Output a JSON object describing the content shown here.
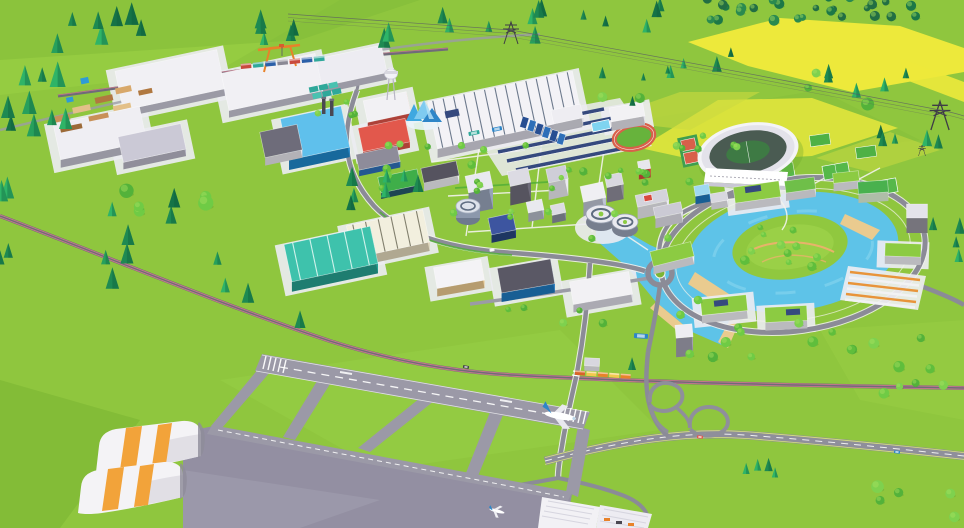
{
  "canvas": {
    "w": 964,
    "h": 528
  },
  "palette": {
    "grass": "#8FC63E",
    "grass_light": "#9AD047",
    "grass_dark": "#7CB534",
    "field_yellow": "#EDE93B",
    "field_pale": "#CBDB40",
    "water": "#5EC3E8",
    "water_light": "#8FD9F0",
    "sand": "#EACB8F",
    "road": "#8B8B97",
    "road_edge": "#F2F2EF",
    "highway": "#8F8F9B",
    "runway": "#9B99A7",
    "apron": "#938FA2",
    "rail": "#6F6B79",
    "rail_pink": "#C9798C",
    "pad": "#ECEBF1",
    "roof_green": "#8CCB42",
    "roof_white": "#F2F1F4",
    "stadium_bowl": "#4A5B52",
    "stadium_shell": "#F4F4F7",
    "pitch": "#3E7A44",
    "track_red": "#D8604A",
    "solar": "#35497E",
    "crane_orange": "#E8822A",
    "hangar_stripe": "#F2A33A",
    "pool": "#7FD4F0"
  },
  "scene": {
    "buildings": [
      [
        "warehouse-nw-a",
        170,
        80,
        104,
        40,
        -12,
        7,
        "#C7C5D3",
        "#F1F0F4",
        1,
        0,
        ""
      ],
      [
        "warehouse-nw-b",
        100,
        133,
        88,
        36,
        -12,
        8,
        "#C2C0CE",
        "#EFEEF3",
        1,
        0,
        ""
      ],
      [
        "warehouse-nw-c",
        152,
        143,
        64,
        26,
        -12,
        7,
        "#B8B6C5",
        "#CBC9D6",
        1,
        0,
        ""
      ],
      [
        "warehouse-n-d",
        272,
        82,
        96,
        38,
        -12,
        7,
        "#C7C5D3",
        "#F1F0F4",
        1,
        0,
        ""
      ],
      [
        "warehouse-n-e",
        346,
        67,
        78,
        28,
        -12,
        7,
        "#C7C5D3",
        "#EDECF2",
        1,
        0,
        ""
      ],
      [
        "factory-blue",
        315,
        133,
        62,
        42,
        -12,
        10,
        "#1F86C8",
        "#5FC0EC",
        1,
        0,
        ""
      ],
      [
        "factory-annex",
        281,
        141,
        38,
        26,
        -12,
        8,
        "#E5E4EB",
        "#6E6C7A",
        0,
        0,
        ""
      ],
      [
        "red-hall-a",
        387,
        107,
        44,
        22,
        -12,
        6,
        "#DE5348",
        "#F2F1F4",
        1,
        0,
        ""
      ],
      [
        "red-hall-b",
        384,
        135,
        48,
        24,
        -12,
        6,
        "#DE5348",
        "#E2584C",
        1,
        0,
        ""
      ],
      [
        "blue-low-office",
        378,
        158,
        42,
        16,
        -12,
        6,
        "#2E6FB8",
        "#8E8C9A",
        0,
        0,
        ""
      ],
      [
        "green-roof-lab",
        399,
        181,
        40,
        16,
        -12,
        6,
        "#27586A",
        "#3FAE49",
        0,
        0,
        ""
      ],
      [
        "production-hall",
        505,
        110,
        148,
        48,
        -12,
        9,
        "#D6D5E0",
        "#F3F2F6",
        1,
        14,
        "#55647A"
      ],
      [
        "office-n1",
        538,
        108,
        46,
        16,
        -12,
        9,
        "#E4E3EA",
        "#F2F1F4",
        1,
        0,
        ""
      ],
      [
        "office-n2",
        567,
        114,
        30,
        14,
        -12,
        8,
        "#DADAE3",
        "#EEEDF2",
        0,
        0,
        ""
      ],
      [
        "office-n3",
        627,
        112,
        34,
        14,
        -10,
        9,
        "#E4E3EA",
        "#F2F1F4",
        1,
        0,
        ""
      ],
      [
        "dark-roof-low",
        440,
        172,
        36,
        15,
        -12,
        8,
        "#EFEFF3",
        "#55535F",
        0,
        0,
        ""
      ],
      [
        "office-tower-a",
        479,
        182,
        25,
        17,
        -12,
        21,
        "#97A3B8",
        "#E9E9EF",
        0,
        0,
        ""
      ],
      [
        "office-tower-b",
        519,
        177,
        21,
        15,
        -12,
        19,
        "#6E6C7A",
        "#DCDBE3",
        0,
        0,
        ""
      ],
      [
        "office-tower-c",
        557,
        174,
        20,
        14,
        -12,
        17,
        "#EBEAF0",
        "#CFCED8",
        0,
        0,
        ""
      ],
      [
        "office-tower-d",
        593,
        192,
        23,
        16,
        -12,
        19,
        "#BFC4D4",
        "#EFEFF3",
        0,
        0,
        ""
      ],
      [
        "office-tower-e",
        614,
        180,
        17,
        12,
        -12,
        15,
        "#8E8C9A",
        "#D8D7DF",
        0,
        0,
        ""
      ],
      [
        "red-cube-office",
        644,
        165,
        12,
        9,
        -10,
        9,
        "#D84A3E",
        "#E8E7ED",
        0,
        0,
        ""
      ],
      [
        "navy-solar-office",
        502,
        224,
        25,
        17,
        -12,
        8,
        "#27457C",
        "#3D55A0",
        0,
        0,
        ""
      ],
      [
        "campus-cube-1",
        535,
        206,
        16,
        11,
        -12,
        9,
        "#B5BAC7",
        "#E9E9EF",
        0,
        0,
        ""
      ],
      [
        "campus-cube-2",
        558,
        209,
        14,
        10,
        -12,
        8,
        "#8A8F9F",
        "#DDDCE4",
        0,
        0,
        ""
      ],
      [
        "slab-east-1",
        652,
        198,
        32,
        12,
        -12,
        12,
        "#EBEAF0",
        "#D4D3DC",
        0,
        0,
        ""
      ],
      [
        "slab-east-2",
        668,
        210,
        28,
        11,
        -12,
        10,
        "#E0DFE8",
        "#CBCAD4",
        0,
        0,
        ""
      ],
      [
        "cream-warehouse",
        388,
        234,
        78,
        33,
        -12,
        9,
        "#E2D7BA",
        "#F2EFDE",
        1,
        6,
        "#6E6C5A"
      ],
      [
        "teal-warehouse",
        331,
        254,
        88,
        38,
        -12,
        10,
        "#27A090",
        "#3EC2AC",
        1,
        5,
        "#EAFBF6"
      ],
      [
        "white-warehouse-s",
        459,
        274,
        48,
        21,
        -10,
        8,
        "#E9C88E",
        "#F4F3F6",
        1,
        0,
        ""
      ],
      [
        "blue-warehouse",
        526,
        276,
        54,
        25,
        -10,
        9,
        "#1F78BE",
        "#5A5865",
        1,
        0,
        ""
      ],
      [
        "east-warehouse",
        601,
        288,
        60,
        23,
        -10,
        8,
        "#DBDAE4",
        "#F2F1F4",
        1,
        0,
        ""
      ],
      [
        "ring-bldg-w",
        672,
        254,
        42,
        15,
        -14,
        8,
        "#EFEEF3",
        "#8CCB42",
        0,
        0,
        ""
      ],
      [
        "ring-bldg-sw",
        724,
        305,
        46,
        16,
        -6,
        8,
        "#EFEEF3",
        "#8CCB42",
        1,
        0,
        ""
      ],
      [
        "ring-bldg-s",
        786,
        314,
        42,
        15,
        -3,
        8,
        "#EFEEF3",
        "#8CCB42",
        1,
        0,
        ""
      ],
      [
        "ring-bldg-e",
        903,
        250,
        36,
        13,
        2,
        8,
        "#EFEEF3",
        "#8CCB42",
        1,
        0,
        ""
      ],
      [
        "ring-tower-e",
        917,
        211,
        21,
        14,
        0,
        15,
        "#97959F",
        "#E4E3EA",
        0,
        0,
        ""
      ],
      [
        "green-facade-ne",
        873,
        187,
        30,
        12,
        -4,
        9,
        "#DFF2D8",
        "#49B14E",
        0,
        0,
        ""
      ],
      [
        "ring-bldg-ne",
        846,
        177,
        26,
        10,
        -6,
        8,
        "#EFEEF3",
        "#8CCB42",
        0,
        0,
        ""
      ],
      [
        "campus-north-1",
        757,
        192,
        46,
        16,
        -8,
        8,
        "#EFEEF3",
        "#8CCB42",
        1,
        0,
        ""
      ],
      [
        "campus-north-2",
        800,
        185,
        30,
        12,
        -8,
        8,
        "#EDEDF2",
        "#6FBF49",
        0,
        0,
        ""
      ],
      [
        "stadium-annex-blue",
        702,
        190,
        15,
        10,
        -10,
        8,
        "#1F78BE",
        "#9FD8F0",
        0,
        0,
        ""
      ],
      [
        "stadium-annex-white",
        719,
        197,
        17,
        9,
        -10,
        7,
        "#EDEDF2",
        "#D8D7DF",
        0,
        0,
        ""
      ],
      [
        "rail-station",
        592,
        362,
        15,
        8,
        3,
        5,
        "#EBEAF0",
        "#D8D7DF",
        0,
        0,
        ""
      ],
      [
        "river-tower",
        684,
        331,
        17,
        13,
        -5,
        19,
        "#A2A0AF",
        "#EEEDF2",
        0,
        0,
        ""
      ]
    ],
    "tree_clusters": [
      [
        "conifer",
        95,
        42,
        48,
        18,
        7,
        8,
        15,
        1
      ],
      [
        "conifer",
        40,
        112,
        30,
        34,
        9,
        8,
        16,
        2
      ],
      [
        "mixed",
        150,
        206,
        56,
        20,
        8,
        7,
        14,
        3
      ],
      [
        "conifer",
        330,
        38,
        70,
        15,
        7,
        7,
        13,
        4
      ],
      [
        "conifer",
        472,
        32,
        80,
        16,
        7,
        6,
        12,
        5
      ],
      [
        "conifer",
        628,
        22,
        48,
        13,
        5,
        6,
        11,
        6
      ],
      [
        "dark",
        760,
        10,
        56,
        11,
        13,
        4,
        8,
        7
      ],
      [
        "dark",
        864,
        8,
        54,
        11,
        13,
        4,
        8,
        8
      ],
      [
        "conifer",
        700,
        68,
        34,
        15,
        5,
        5,
        10,
        9
      ],
      [
        "mixed",
        852,
        88,
        55,
        20,
        8,
        5,
        10,
        10
      ],
      [
        "conifer",
        912,
        140,
        32,
        16,
        5,
        6,
        11,
        11
      ],
      [
        "round",
        505,
        196,
        140,
        52,
        24,
        3,
        6,
        12
      ],
      [
        "round",
        790,
        247,
        46,
        20,
        11,
        3,
        7,
        13
      ],
      [
        "round",
        795,
        336,
        128,
        22,
        12,
        4,
        8,
        14
      ],
      [
        "round",
        888,
        362,
        66,
        32,
        8,
        4,
        9,
        15
      ],
      [
        "conifer",
        185,
        296,
        88,
        33,
        6,
        8,
        15,
        16
      ],
      [
        "conifer",
        756,
        483,
        28,
        16,
        4,
        6,
        12,
        17
      ],
      [
        "round",
        914,
        500,
        42,
        18,
        5,
        5,
        10,
        18
      ],
      [
        "round",
        660,
        162,
        45,
        22,
        7,
        3,
        6,
        19
      ],
      [
        "conifer",
        368,
        196,
        38,
        16,
        5,
        7,
        12,
        20
      ],
      [
        "round",
        545,
        320,
        58,
        13,
        5,
        3,
        6,
        21
      ],
      [
        "conifer",
        946,
        240,
        16,
        24,
        4,
        6,
        11,
        22
      ],
      [
        "mixed",
        620,
        92,
        36,
        16,
        5,
        4,
        8,
        23
      ],
      [
        "round",
        712,
        140,
        30,
        12,
        5,
        3,
        5,
        24
      ],
      [
        "conifer",
        8,
        230,
        10,
        40,
        4,
        8,
        14,
        25
      ],
      [
        "round",
        335,
        110,
        22,
        10,
        4,
        3,
        5,
        26
      ]
    ],
    "tree_singles": [
      [
        "conifer",
        8,
        118,
        14
      ],
      [
        "conifer",
        352,
        186,
        12
      ],
      [
        "conifer",
        418,
        192,
        11
      ],
      [
        "conifer",
        300,
        328,
        11
      ],
      [
        "conifer",
        632,
        370,
        8
      ],
      [
        "conifer",
        128,
        245,
        13
      ],
      [
        "round",
        698,
        300,
        6
      ],
      [
        "round",
        668,
        238,
        5
      ]
    ],
    "tree_colors": {
      "conifer": [
        "#157347",
        "#1E8A52",
        "#27A05C",
        "#2FB467"
      ],
      "round": [
        "#5FBE3C",
        "#6FCB45",
        "#53B23A",
        "#7ED14E"
      ],
      "dark": [
        "#1C7847",
        "#226E43",
        "#2A8A4F"
      ]
    },
    "vehicles": [
      [
        "truck-teal",
        474,
        133,
        11,
        4,
        -12,
        "#2FA89A"
      ],
      [
        "truck-blue",
        497,
        129,
        10,
        4,
        -12,
        "#2E86C8"
      ],
      [
        "bus-blue",
        641,
        336,
        14,
        5,
        4,
        "#2E86C8"
      ],
      [
        "car-dark",
        466,
        367,
        6,
        3,
        12,
        "#3E3C46"
      ],
      [
        "car-blue-highway",
        897,
        452,
        6,
        3,
        8,
        "#2E86C8"
      ],
      [
        "car-white",
        492,
        250,
        5,
        3,
        -10,
        "#F2F2F4"
      ],
      [
        "car-red",
        700,
        437,
        6,
        3,
        6,
        "#E2574C"
      ]
    ],
    "trains": [
      {
        "name": "freight-train",
        "x": 246,
        "y": 66,
        "dx": 12.2,
        "dy": -1.2,
        "w": 10.5,
        "h": 5,
        "colors": [
          "#C94A3E",
          "#2FA89A",
          "#2B5FA8",
          "#8A8894",
          "#C94A3E",
          "#2B5FA8",
          "#2FA89A"
        ]
      },
      {
        "name": "cargo-train",
        "x": 580,
        "y": 373,
        "dx": 11.4,
        "dy": 0.8,
        "w": 10,
        "h": 4.5,
        "colors": [
          "#D86428",
          "#F2C94E",
          "#E8822A",
          "#F2C94E",
          "#E8822A"
        ]
      }
    ],
    "pylons": [
      [
        511,
        44,
        1.0
      ],
      [
        940,
        130,
        1.3
      ],
      [
        922,
        156,
        0.5
      ]
    ]
  }
}
